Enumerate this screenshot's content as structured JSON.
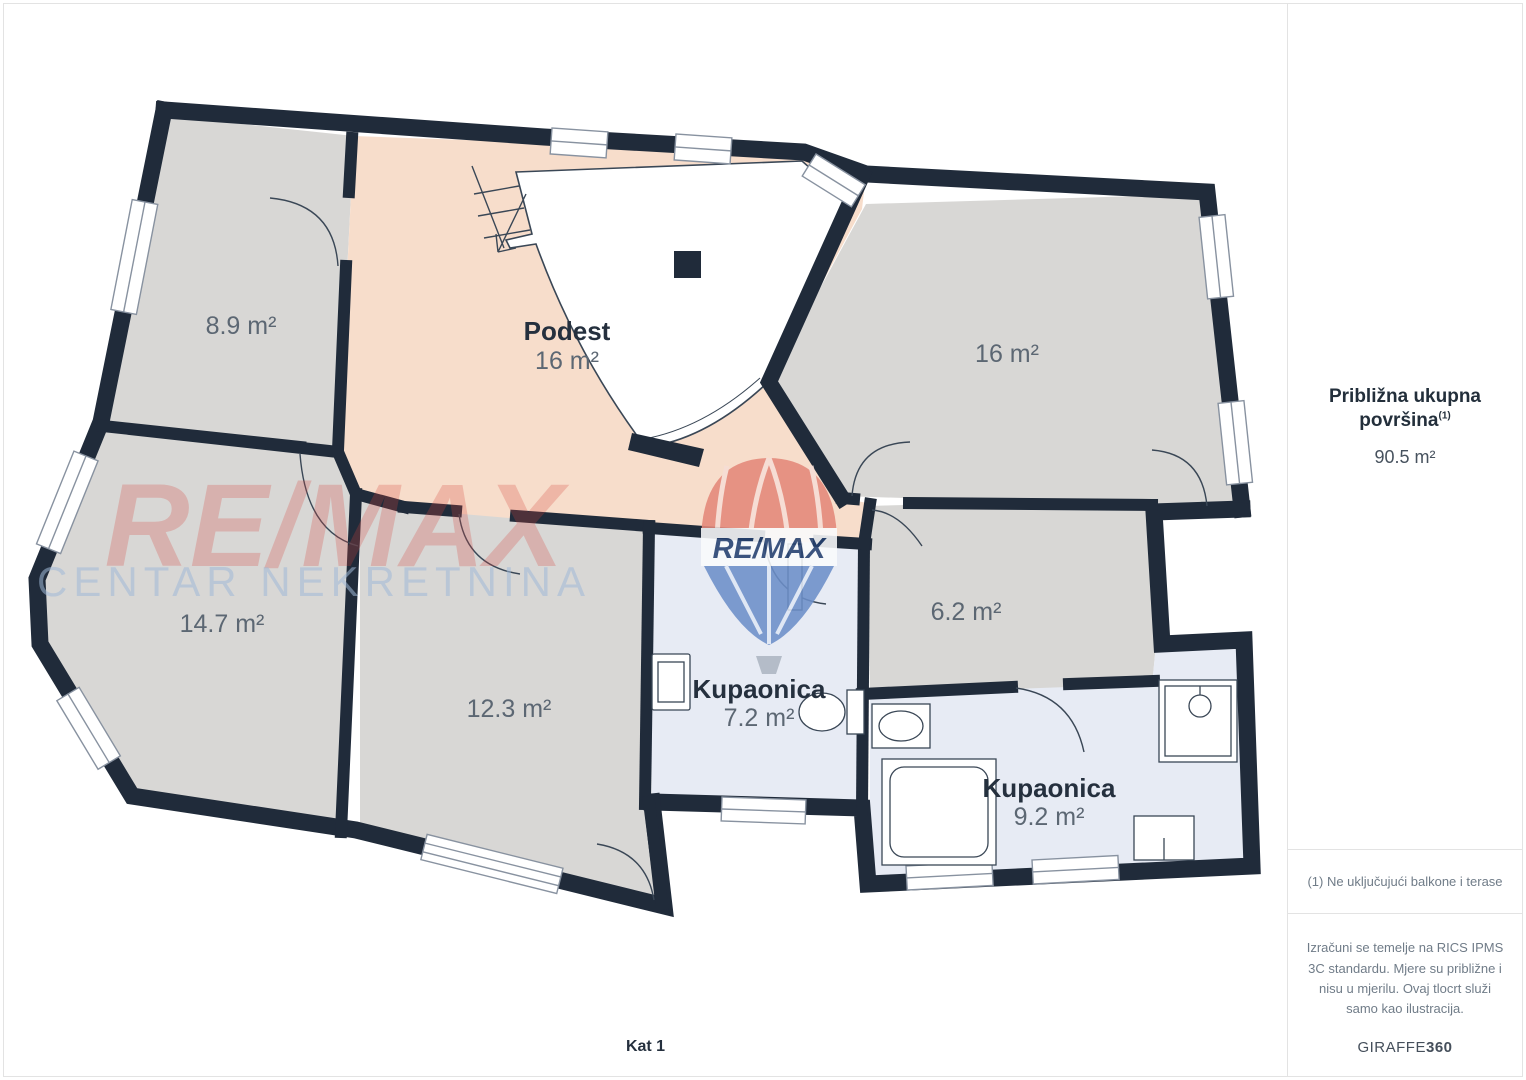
{
  "floor_plan": {
    "title": "Kat 1",
    "rooms": [
      {
        "name": "",
        "area": "8.9 m²"
      },
      {
        "name": "Podest",
        "area": "16 m²"
      },
      {
        "name": "",
        "area": "16 m²"
      },
      {
        "name": "",
        "area": "14.7 m²"
      },
      {
        "name": "",
        "area": "12.3 m²"
      },
      {
        "name": "Kupaonica",
        "area": "7.2 m²"
      },
      {
        "name": "",
        "area": "6.2 m²"
      },
      {
        "name": "Kupaonica",
        "area": "9.2 m²"
      }
    ]
  },
  "watermark": {
    "primary": "RE/MAX",
    "secondary": "CENTAR NEKRETNINA",
    "balloon_label": "RE/MAX"
  },
  "sidebar": {
    "total_area_label": "Približna ukupna površina",
    "total_area_sup": "(1)",
    "total_area_value": "90.5 m²",
    "footnote": "(1) Ne uključujući balkone i terase",
    "disclaimer": "Izračuni se temelje na RICS IPMS 3C standardu. Mjere su približne i nisu u mjerilu. Ovaj tlocrt služi samo kao ilustracija.",
    "brand": "GIRAFFE",
    "brand_suffix": "360"
  },
  "colors": {
    "wall": "#202b3a",
    "room_gray": "#d8d7d5",
    "room_peach": "#f7ddcb",
    "room_blue": "#e7ebf4",
    "label_dark": "#25303e",
    "label_gray": "#5c6773",
    "watermark_red": "#d6453d",
    "watermark_blue": "#a0b9d7"
  }
}
